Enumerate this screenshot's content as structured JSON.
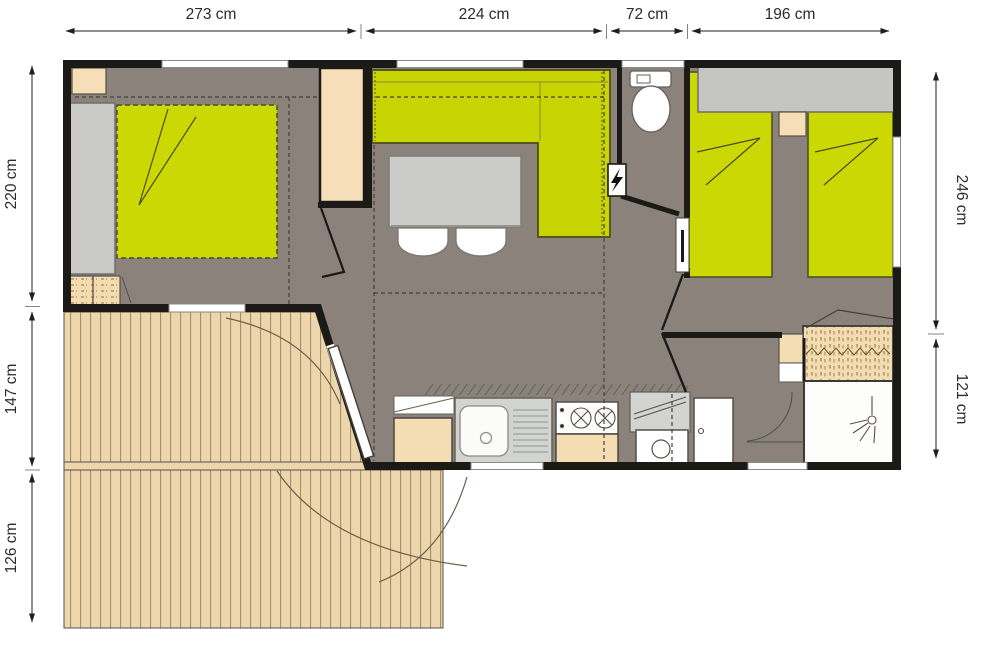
{
  "plan": {
    "dims": {
      "top": [
        {
          "label": "273 cm"
        },
        {
          "label": "224 cm"
        },
        {
          "label": "72 cm"
        },
        {
          "label": "196 cm"
        }
      ],
      "left": [
        {
          "label": "220 cm"
        },
        {
          "label": "147 cm"
        },
        {
          "label": "126 cm"
        }
      ],
      "right": [
        {
          "label": "246 cm"
        },
        {
          "label": "121 cm"
        }
      ]
    },
    "colors": {
      "wall": "#1c1a17",
      "floor": "#8b827c",
      "upholstery_green": "#cbd603",
      "deck_wood": "#eed6ac",
      "cabinet_beige": "#f4ddb3",
      "furniture_gray": "#c7c7c5",
      "fixture_white": "#ffffff",
      "dimension_text": "#2b2b2b"
    },
    "icons": {
      "electrical_panel": "lightning-bolt",
      "shower_head": "spray-symbol",
      "toilet": "toilet-top-view"
    }
  }
}
